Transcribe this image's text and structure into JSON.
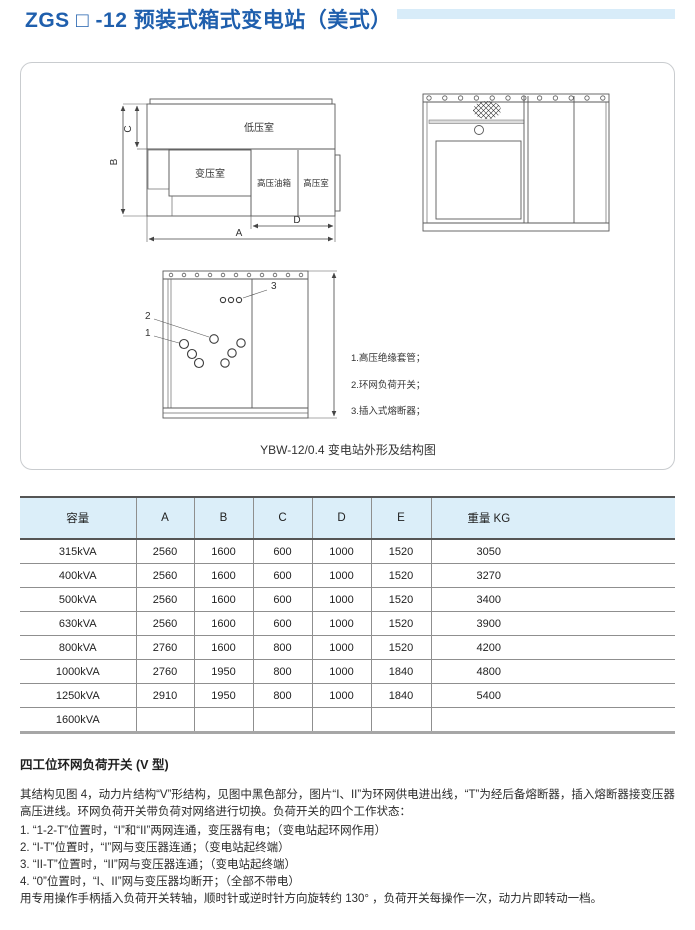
{
  "colors": {
    "accent-blue": "#1f5fad",
    "bar-blue": "#d8ecf9",
    "table-header-bg": "#dbeef9"
  },
  "page": {
    "title": "ZGS □ -12 预装式箱式变电站（美式）"
  },
  "figure": {
    "caption": "YBW-12/0.4 变电站外形及结构图",
    "plan_labels": {
      "low_voltage_room": "低压室",
      "transformer_room": "变压室",
      "hv_oil_tank": "高压油箱",
      "hv_room": "高压室",
      "dim_a": "A",
      "dim_b": "B",
      "dim_c": "C",
      "dim_d": "D"
    },
    "structure_labels": {
      "callout_1": "1",
      "callout_2": "2",
      "callout_3": "3",
      "legend_1": "1.高压绝缘套管；",
      "legend_2": "2.环网负荷开关；",
      "legend_3": "3.插入式熔断器；"
    }
  },
  "table": {
    "headers": [
      "容量",
      "A",
      "B",
      "C",
      "D",
      "E",
      "重量 KG"
    ],
    "rows": [
      [
        "315kVA",
        "2560",
        "1600",
        "600",
        "1000",
        "1520",
        "3050"
      ],
      [
        "400kVA",
        "2560",
        "1600",
        "600",
        "1000",
        "1520",
        "3270"
      ],
      [
        "500kVA",
        "2560",
        "1600",
        "600",
        "1000",
        "1520",
        "3400"
      ],
      [
        "630kVA",
        "2560",
        "1600",
        "600",
        "1000",
        "1520",
        "3900"
      ],
      [
        "800kVA",
        "2760",
        "1600",
        "800",
        "1000",
        "1520",
        "4200"
      ],
      [
        "1000kVA",
        "2760",
        "1950",
        "800",
        "1000",
        "1840",
        "4800"
      ],
      [
        "1250kVA",
        "2910",
        "1950",
        "800",
        "1000",
        "1840",
        "5400"
      ],
      [
        "1600kVA",
        "",
        "",
        "",
        "",
        "",
        ""
      ]
    ]
  },
  "switch_section": {
    "heading": "四工位环网负荷开关 (V 型)",
    "intro": "其结构见图 4，动力片结构“V”形结构，见图中黑色部分，图片“I、II”为环网供电进出线，“T”为经后备熔断器，插入熔断器接变压器高压进线。环网负荷开关带负荷对网络进行切换。负荷开关的四个工作状态：",
    "items": [
      "1. “1-2-T”位置时，“I”和“II”两网连通，变压器有电；（变电站起环网作用）",
      "2. “I-T”位置时，“I”网与变压器连通；（变电站起终端）",
      "3. “II-T”位置时，“II”网与变压器连通；（变电站起终端）",
      "4. “0”位置时，“I、II”网与变压器均断开；（全部不带电）"
    ],
    "outro": "用专用操作手柄插入负荷开关转轴，顺时针或逆时针方向旋转约 130° ，负荷开关每操作一次，动力片即转动一档。"
  }
}
